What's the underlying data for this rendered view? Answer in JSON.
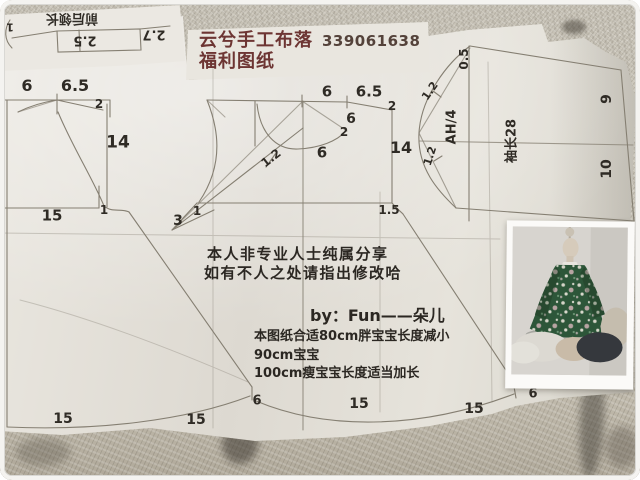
{
  "title": {
    "brand": "云兮手工布落",
    "number": "339061638",
    "subtitle": "福利图纸"
  },
  "flipped_patch": {
    "caption": "前后领长",
    "m1": "2.5",
    "m2": "2.7",
    "m3": "1"
  },
  "front": {
    "neck": "6",
    "shoulder": "6.5",
    "drop": "2",
    "cf_len": "14",
    "waist": "15",
    "waist_gap": "1",
    "hem1": "15",
    "hem2": "15",
    "hem_side": "6"
  },
  "back": {
    "neck": "6",
    "shoulder": "6.5",
    "drop": "2",
    "neck2": "6",
    "drop2": "2",
    "width": "6",
    "cb_len": "14",
    "ease": "1.2",
    "dart": "3",
    "dart_gap": "1",
    "side": "1.5",
    "hem1": "15",
    "hem2": "15",
    "hem_side": "6"
  },
  "sleeve": {
    "cap_top": "0.5",
    "cap_ease_upper": "1.2",
    "cap_chord": "AH/4",
    "cap_ease_lower": "1.2",
    "length": "袖长28",
    "cuff_upper": "9",
    "cuff_lower": "10"
  },
  "notes": {
    "line1": "本人非专业人士纯属分享",
    "line2": "如有不人之处请指出修改哈",
    "byline": "by：Fun——朵儿",
    "size1": "本图纸合适80cm胖宝宝长度减小",
    "size2": "90cm宝宝",
    "size3": "100cm瘦宝宝长度适当加长"
  },
  "photo": {
    "content": "green-floral-dress-on-child-mannequin"
  },
  "colors": {
    "title_ink": "#6d3533",
    "number_ink": "#54423a",
    "pencil": "#857f72",
    "label_ink": "#2f2b25",
    "paper": "#e6e3dc",
    "carpet": "#c7c2b6",
    "dress_green": "#2d5639",
    "photo_wall": "#d9d6d1"
  }
}
